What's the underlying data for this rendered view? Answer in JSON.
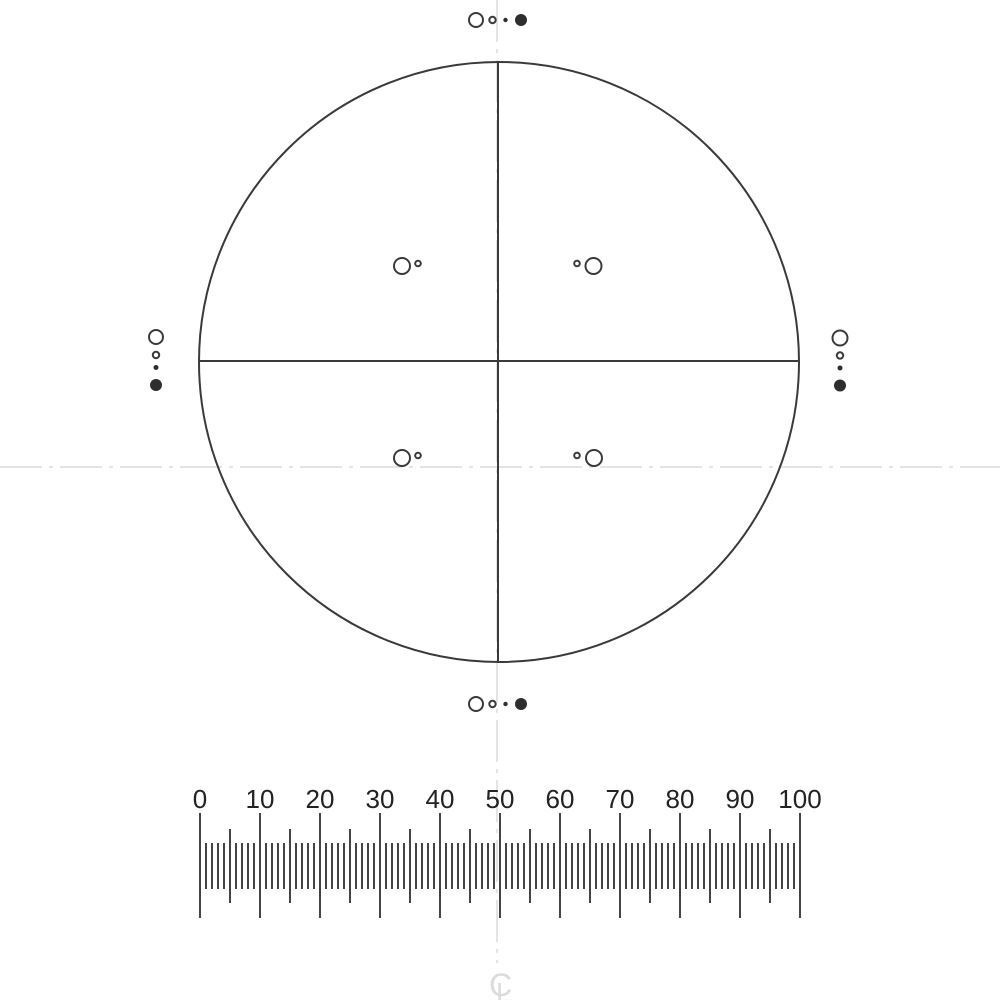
{
  "image_type": "microscope-reticle-calibration-drawing",
  "colors": {
    "background": "#ffffff",
    "line": "#3a3a3a",
    "fill_dot": "#2e2e2e",
    "tick": "#444444",
    "label": "#222222",
    "centerline": "#e4e4e4",
    "centerline_symbol": "#dcdcdc"
  },
  "reticle": {
    "circle": {
      "cx": 499,
      "cy": 362,
      "r": 300,
      "stroke_width": 2
    },
    "crosshair": {
      "horizontal": {
        "x1": 199,
        "x2": 799,
        "y": 361
      },
      "vertical": {
        "x": 498,
        "y1": 62,
        "y2": 663
      },
      "stroke_width": 2
    },
    "edge_patterns": [
      {
        "name": "top-pattern",
        "circles": [
          {
            "cx": 476,
            "cy": 20,
            "r": 7,
            "fill": false
          },
          {
            "cx": 492.5,
            "cy": 20,
            "r": 3.2,
            "fill": false
          },
          {
            "cx": 505.5,
            "cy": 20,
            "r": 2.2,
            "fill": true
          },
          {
            "cx": 521,
            "cy": 20,
            "r": 6,
            "fill": true
          }
        ]
      },
      {
        "name": "bottom-pattern",
        "circles": [
          {
            "cx": 476,
            "cy": 704,
            "r": 7,
            "fill": false
          },
          {
            "cx": 492.5,
            "cy": 704,
            "r": 3.2,
            "fill": false
          },
          {
            "cx": 505.5,
            "cy": 704,
            "r": 2.2,
            "fill": true
          },
          {
            "cx": 521,
            "cy": 704,
            "r": 6,
            "fill": true
          }
        ]
      },
      {
        "name": "left-pattern",
        "circles": [
          {
            "cx": 156,
            "cy": 337,
            "r": 7,
            "fill": false
          },
          {
            "cx": 156,
            "cy": 355,
            "r": 3.2,
            "fill": false
          },
          {
            "cx": 156,
            "cy": 367.5,
            "r": 2.5,
            "fill": true
          },
          {
            "cx": 156,
            "cy": 385,
            "r": 6,
            "fill": true
          }
        ]
      },
      {
        "name": "right-pattern",
        "circles": [
          {
            "cx": 840,
            "cy": 338,
            "r": 7.5,
            "fill": false
          },
          {
            "cx": 840,
            "cy": 355.5,
            "r": 3.2,
            "fill": false
          },
          {
            "cx": 840,
            "cy": 368,
            "r": 2.5,
            "fill": true
          },
          {
            "cx": 840,
            "cy": 385.5,
            "r": 6,
            "fill": true
          }
        ]
      }
    ],
    "quadrant_pairs": [
      {
        "name": "upper-left-pair",
        "circles": [
          {
            "cx": 402,
            "cy": 266,
            "r": 8,
            "fill": false
          },
          {
            "cx": 418,
            "cy": 263.5,
            "r": 2.8,
            "fill": false
          }
        ]
      },
      {
        "name": "upper-right-pair",
        "circles": [
          {
            "cx": 577,
            "cy": 263.5,
            "r": 2.8,
            "fill": false
          },
          {
            "cx": 593.5,
            "cy": 266,
            "r": 8,
            "fill": false
          }
        ]
      },
      {
        "name": "lower-left-pair",
        "circles": [
          {
            "cx": 402,
            "cy": 458,
            "r": 8,
            "fill": false
          },
          {
            "cx": 418,
            "cy": 455.5,
            "r": 2.8,
            "fill": false
          }
        ]
      },
      {
        "name": "lower-right-pair",
        "circles": [
          {
            "cx": 577,
            "cy": 455.5,
            "r": 2.8,
            "fill": false
          },
          {
            "cx": 594,
            "cy": 458,
            "r": 8,
            "fill": false
          }
        ]
      }
    ]
  },
  "centerlines": {
    "dash_pattern": "42 7 4 7",
    "stroke_width": 2,
    "vertical": {
      "x": 497,
      "y1": 0,
      "y2": 963
    },
    "horizontal": {
      "y": 467,
      "x1": 0,
      "x2": 1000
    },
    "symbol": {
      "letters": [
        {
          "char": "C",
          "x": 489,
          "y": 996,
          "font_size": 32
        },
        {
          "char": "L",
          "x": 496,
          "y": 1002,
          "font_size": 28
        }
      ]
    }
  },
  "chart_data": {
    "type": "table",
    "title": "",
    "scale_labels": [
      "0",
      "10",
      "20",
      "30",
      "40",
      "50",
      "60",
      "70",
      "80",
      "90",
      "100"
    ],
    "scale_range": [
      0,
      100
    ],
    "minor_division": 1,
    "mid_division": 5,
    "major_division": 10
  },
  "scale": {
    "x_start": 200,
    "x_end": 800,
    "num_units": 100,
    "labels": [
      "0",
      "10",
      "20",
      "30",
      "40",
      "50",
      "60",
      "70",
      "80",
      "90",
      "100"
    ],
    "label_step_units": 10,
    "label_baseline_y": 808,
    "label_font_size": 26,
    "tick_width": 2,
    "major": {
      "every": 10,
      "y1": 813,
      "y2": 918
    },
    "mid": {
      "every": 5,
      "y1": 829,
      "y2": 903
    },
    "minor": {
      "every": 1,
      "y1": 843,
      "y2": 889
    }
  }
}
